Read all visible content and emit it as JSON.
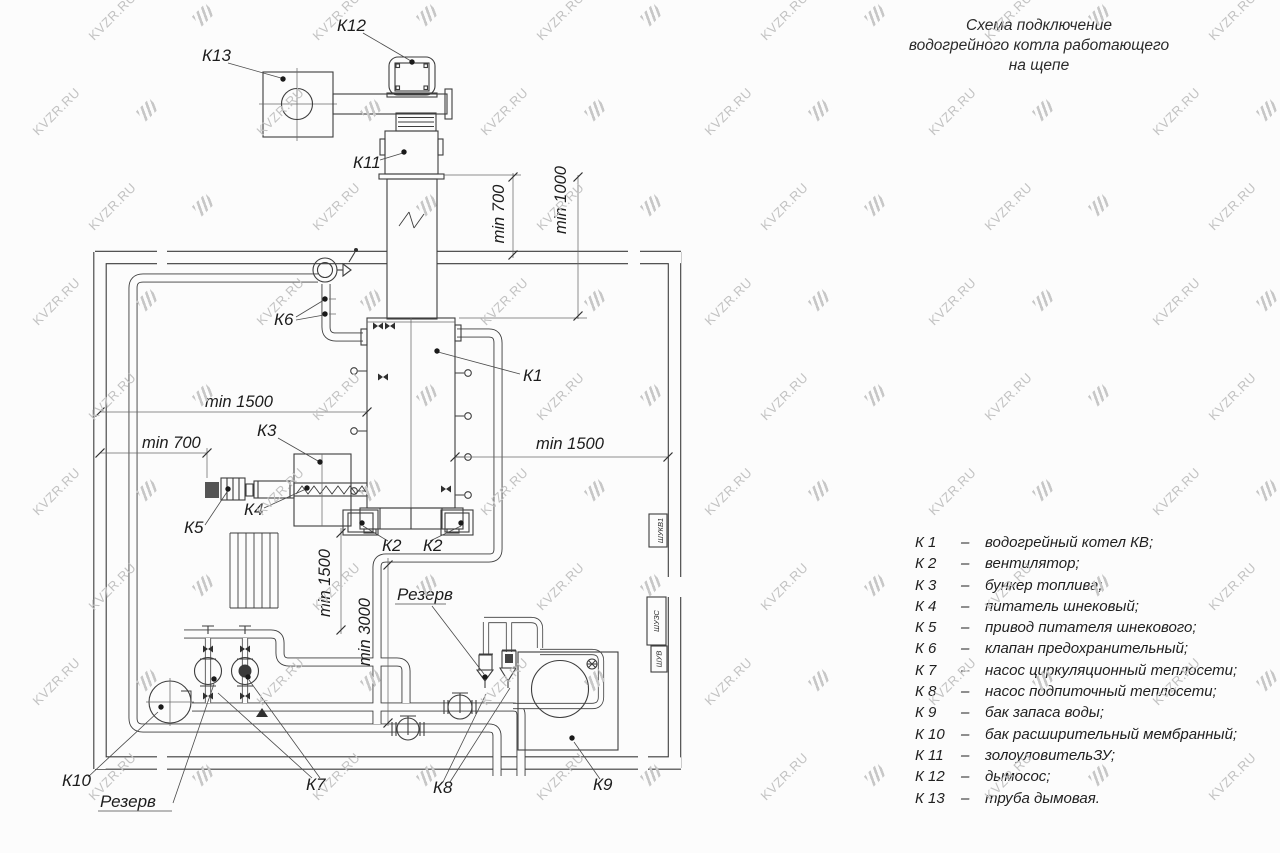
{
  "title": {
    "lines": [
      "Схема подключение",
      "водогрейного котла работающего",
      "на щепе"
    ]
  },
  "watermark": {
    "text": "KVZR.RU"
  },
  "legend": {
    "dash": "–",
    "items": [
      {
        "key": "К 1",
        "desc": "водогрейный котел КВ;"
      },
      {
        "key": "К 2",
        "desc": "вентилятор;"
      },
      {
        "key": "К 3",
        "desc": "бункер топлива;"
      },
      {
        "key": "К 4",
        "desc": "питатель шнековый;"
      },
      {
        "key": "К 5",
        "desc": "привод питателя шнекового;"
      },
      {
        "key": "К 6",
        "desc": "клапан предохранительный;"
      },
      {
        "key": "К 7",
        "desc": "насос циркуляционный теплосети;"
      },
      {
        "key": "К 8",
        "desc": "насос подпиточный теплосети;"
      },
      {
        "key": "К 9",
        "desc": "бак запаса воды;"
      },
      {
        "key": "К 10",
        "desc": "бак расширительный мембранный;"
      },
      {
        "key": "К 11",
        "desc": "золоуловительЗУ;"
      },
      {
        "key": "К 12",
        "desc": "дымосос;"
      },
      {
        "key": "К 13",
        "desc": "труба дымовая."
      }
    ]
  },
  "labels": {
    "k1": "К1",
    "k2a": "К2",
    "k2b": "К2",
    "k3": "К3",
    "k4": "К4",
    "k5": "К5",
    "k6": "К6",
    "k7": "К7",
    "k8": "К8",
    "k9": "К9",
    "k10": "К10",
    "k11": "К11",
    "k12": "К12",
    "k13": "К13",
    "reserve_top": "Резерв",
    "reserve_bottom": "Резерв"
  },
  "dimensions": {
    "h1500_left": "min 1500",
    "h700_left": "min 700",
    "h1500_right": "min 1500",
    "v700": "min 700",
    "v1000": "min 1000",
    "v1500": "min 1500",
    "v3000": "min 3000"
  },
  "cabinets": {
    "c1": "ШУКВ1",
    "c2": "ШУЗС",
    "c3": "ШУВ"
  }
}
